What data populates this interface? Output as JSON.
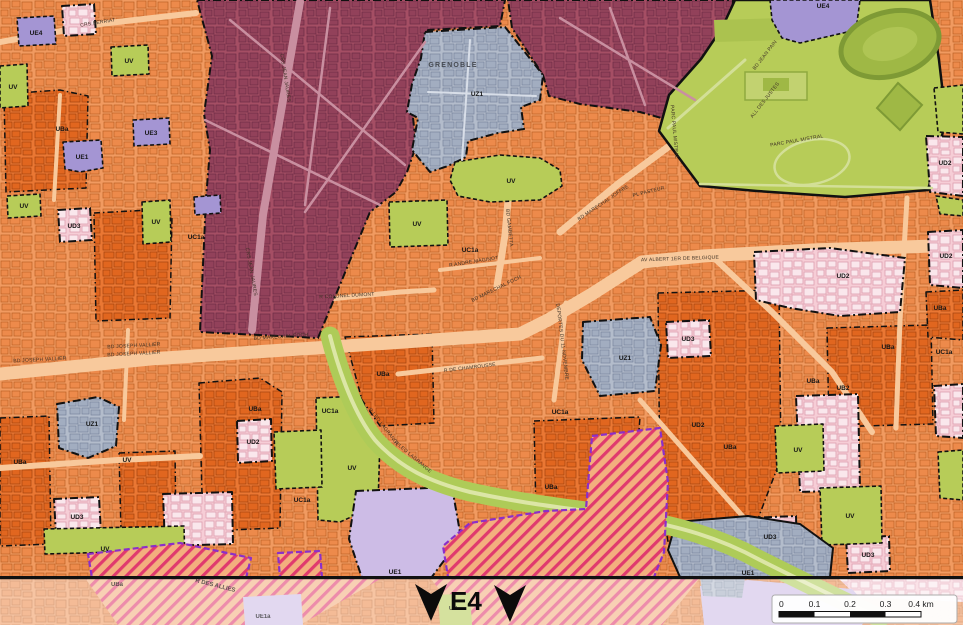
{
  "sheet": {
    "label": "E4"
  },
  "city_label": {
    "text": "GRENOBLE",
    "x": 453,
    "y": 67
  },
  "palette": {
    "base_orange": "#F19A60",
    "deep_orange": "#EA7733",
    "road": "#F8C99C",
    "maroon": "#A54E64",
    "blue_gray": "#B3BCCB",
    "green": "#B7CC58",
    "pink": "#F6CDD6",
    "purple": "#A495D3",
    "light_purple": "#CDBCE6",
    "hatch_stripe": "#E03A6E",
    "hatch_border": "#8B2FC9",
    "divider": "#111111"
  },
  "deep_zones": [
    {
      "n": "UBa",
      "f": "deep",
      "s": "dash1",
      "p": "4,94 60,90 88,96 86,188 6,192"
    },
    {
      "n": "UBa",
      "f": "deep",
      "s": "dash1",
      "p": "94,213 150,210 172,216 170,318 96,321"
    },
    {
      "n": "UBa",
      "f": "deep",
      "s": "dash1",
      "p": "345,337 432,334 434,423 380,426 362,400"
    },
    {
      "n": "UBa",
      "f": "deep",
      "s": "dash1",
      "p": "119,453 175,451 176,529 121,531"
    },
    {
      "n": "UBa",
      "f": "deep",
      "s": "dash1",
      "p": "0,418 49,416 51,544 0,546"
    },
    {
      "n": "UBa",
      "f": "deep",
      "s": "dash1",
      "p": "199,383 260,378 282,392 280,528 203,531"
    },
    {
      "n": "UBa",
      "f": "deep",
      "s": "dash1",
      "p": "658,293 779,290 781,458 750,540 668,542 660,492"
    },
    {
      "n": "UBa",
      "f": "deep",
      "s": "dash1",
      "p": "827,328 931,325 933,424 829,427"
    },
    {
      "n": "UBa",
      "f": "deep",
      "s": "dash1",
      "p": "534,421 640,417 636,470 600,478 594,508 536,513"
    },
    {
      "n": "UBa",
      "f": "deep",
      "s": "dash1",
      "p": "926,292 963,290 963,340 928,337"
    }
  ],
  "roads": [
    {
      "d": "M0,374 L150,359 L360,345 L520,334 L548,320 L592,294 L642,262 L703,256 L812,250 L963,245",
      "w": 13
    },
    {
      "d": "M497,286 L505,235 L510,178",
      "w": 7
    },
    {
      "d": "M560,232 L618,184 L668,147 L702,127",
      "w": 7
    },
    {
      "d": "M713,257 L772,312 L832,372 L872,432",
      "w": 6
    },
    {
      "d": "M398,374 L470,366 L542,358",
      "w": 5
    },
    {
      "d": "M554,400 L562,338 L566,303",
      "w": 5
    },
    {
      "d": "M320,300 L400,292 L434,290",
      "w": 5
    },
    {
      "d": "M0,42 L100,24 L196,13",
      "w": 6
    },
    {
      "d": "M640,400 L700,468 L746,520",
      "w": 5
    },
    {
      "d": "M907,198 L900,320 L896,428",
      "w": 5
    },
    {
      "d": "M440,270 L540,258",
      "w": 4
    },
    {
      "d": "M60,95 L54,200",
      "w": 4
    },
    {
      "d": "M128,330 L124,420",
      "w": 4
    },
    {
      "d": "M0,468 L118,460 L200,456",
      "w": 6
    }
  ],
  "zones": [
    {
      "n": "UA-center",
      "f": "ma",
      "s": "dash",
      "p": "197,0 505,0 500,26 428,30 422,58 412,108 416,146 407,172 396,192 370,212 318,338 200,332 206,198 210,150 204,114 212,56"
    },
    {
      "n": "UA-center-east",
      "f": "ma",
      "s": "dash",
      "p": "508,0 733,0 730,64 708,94 697,128 640,112 580,104 549,96 543,75 512,28"
    },
    {
      "n": "parc-paul-mistral",
      "f": "park",
      "s": "solid2",
      "p": "735,0 930,0 939,60 946,120 937,155 928,190 845,197 757,191 700,186 659,131 669,95 701,59 722,28"
    },
    {
      "n": "park-block",
      "f": "dkgreen",
      "s": "none",
      "p": "714,20 783,18 782,40 715,42"
    },
    {
      "n": "UE4",
      "f": "pu",
      "s": "dashf",
      "p": "770,0 860,0 856,30 800,43 782,38 772,20"
    },
    {
      "n": "UV",
      "f": "uv",
      "s": "dashf",
      "p": "934,88 963,85 963,134 938,132"
    },
    {
      "n": "UD2",
      "f": "pk",
      "s": "dash",
      "p": "926,136 963,137 963,196 930,192"
    },
    {
      "n": "UV",
      "f": "uv",
      "s": "dashf",
      "p": "936,196 963,200 963,216 940,214"
    },
    {
      "n": "UD2",
      "f": "pk",
      "s": "dash",
      "p": "928,232 963,230 963,288 930,285"
    },
    {
      "n": "UV",
      "f": "uv",
      "s": "dashf",
      "p": "938,452 963,450 963,500 940,498"
    },
    {
      "n": "UD",
      "f": "pk",
      "s": "dash",
      "p": "62,6 94,4 96,34 64,36"
    },
    {
      "n": "UE4",
      "f": "pu",
      "s": "dashf",
      "p": "17,18 54,16 56,44 19,46"
    },
    {
      "n": "UV",
      "f": "uv",
      "s": "dashf",
      "p": "111,47 148,45 149,74 112,76"
    },
    {
      "n": "UV",
      "f": "uv",
      "s": "dashf",
      "p": "0,66 27,64 28,106 0,108"
    },
    {
      "n": "UE3",
      "f": "pu",
      "s": "dashf",
      "p": "133,120 169,118 170,144 134,146"
    },
    {
      "n": "UE1",
      "f": "pu",
      "s": "dashf",
      "p": "63,142 101,140 103,168 80,172 65,169"
    },
    {
      "n": "UD3",
      "f": "pk",
      "s": "dash",
      "p": "58,210 90,208 92,240 60,242"
    },
    {
      "n": "UV",
      "f": "uv",
      "s": "dashf",
      "p": "7,196 40,194 41,216 8,218"
    },
    {
      "n": "UV",
      "f": "uv",
      "s": "dashf",
      "p": "142,202 170,200 171,242 143,244"
    },
    {
      "n": "UE1",
      "f": "pu",
      "s": "dashf",
      "p": "194,197 220,195 221,213 195,215"
    },
    {
      "n": "UZ1-grenoble",
      "f": "gy",
      "s": "dash",
      "p": "425,32 505,27 543,75 540,100 521,107 524,129 498,133 468,141 466,157 448,166 430,172 412,150 418,118 407,112 412,84 421,58"
    },
    {
      "n": "UV",
      "f": "uv",
      "s": "dashf",
      "p": "455,162 500,155 540,158 560,170 562,186 540,200 490,202 458,196 450,180"
    },
    {
      "n": "UV",
      "f": "uv",
      "s": "dashf",
      "p": "389,202 447,200 448,245 390,247"
    },
    {
      "n": "UZ1",
      "f": "gy",
      "s": "dash",
      "p": "583,322 650,317 661,345 655,391 600,396 582,360"
    },
    {
      "n": "UZ1",
      "f": "gy",
      "s": "dash",
      "p": "57,404 98,397 119,407 116,446 88,458 59,448"
    },
    {
      "n": "UD2",
      "f": "pk",
      "s": "dash",
      "p": "754,252 830,248 905,258 900,312 840,316 790,308 756,300"
    },
    {
      "n": "UD3",
      "f": "pk",
      "s": "dash",
      "p": "666,322 709,320 711,356 668,358"
    },
    {
      "n": "UD2",
      "f": "pk",
      "s": "dash",
      "p": "796,396 858,394 860,490 800,492"
    },
    {
      "n": "UD2",
      "f": "pk",
      "s": "dash",
      "p": "237,421 271,419 272,461 238,463"
    },
    {
      "n": "UD3",
      "f": "pk",
      "s": "dash",
      "p": "54,499 99,497 101,534 56,536"
    },
    {
      "n": "UD",
      "f": "pk",
      "s": "dash",
      "p": "163,494 232,492 233,544 165,546"
    },
    {
      "n": "UD3",
      "f": "pk",
      "s": "dash",
      "p": "748,518 796,516 797,556 750,558"
    },
    {
      "n": "UD3",
      "f": "pk",
      "s": "dash",
      "p": "846,538 889,536 890,571 848,573"
    },
    {
      "n": "UD",
      "f": "pk",
      "s": "dash",
      "p": "934,386 963,384 963,438 936,436"
    },
    {
      "n": "UV",
      "f": "uv",
      "s": "dashf",
      "p": "44,529 184,526 185,566 120,568 118,552 45,554"
    },
    {
      "n": "UV",
      "f": "uv",
      "s": "dashf",
      "p": "316,398 360,396 380,440 378,505 340,522 318,520"
    },
    {
      "n": "UV",
      "f": "uv",
      "s": "dashf",
      "p": "274,432 321,430 322,487 276,489"
    },
    {
      "n": "UV",
      "f": "uv",
      "s": "dashf",
      "p": "775,426 823,424 824,471 777,473"
    },
    {
      "n": "UV",
      "f": "uv",
      "s": "dashf",
      "p": "820,488 881,486 882,543 822,545"
    },
    {
      "n": "UE1",
      "f": "pulight",
      "s": "dash",
      "p": "356,491 452,487 461,538 431,578 362,578 349,539"
    },
    {
      "n": "UE1",
      "f": "gy",
      "s": "solid",
      "p": "676,522 748,516 800,524 833,548 830,577 680,577 668,550"
    }
  ],
  "zone_roads": [
    {
      "d": "M300,2 L283,100 L263,215 L252,330",
      "w": 8,
      "c": "#C98FA0"
    },
    {
      "d": "M230,20 L405,165",
      "w": 2.5,
      "c": "#C98FA0"
    },
    {
      "d": "M205,120 L380,205",
      "w": 2.5,
      "c": "#C98FA0"
    },
    {
      "d": "M330,8 L305,205",
      "w": 2.5,
      "c": "#C98FA0"
    },
    {
      "d": "M425,42 L305,212",
      "w": 2.5,
      "c": "#C98FA0"
    },
    {
      "d": "M560,18 L695,100",
      "w": 2.5,
      "c": "#C98FA0"
    },
    {
      "d": "M610,8 L645,105",
      "w": 2.5,
      "c": "#C98FA0"
    },
    {
      "d": "M470,40 L462,160",
      "w": 2,
      "c": "#D8DEE8"
    },
    {
      "d": "M428,92 L536,96",
      "w": 2,
      "c": "#D8DEE8"
    },
    {
      "d": "M700,184 L932,188",
      "w": 2.5,
      "c": "#D3DF97"
    },
    {
      "d": "M668,128 L745,60",
      "w": 3,
      "c": "#D3DF97"
    }
  ],
  "park_decor": [
    {
      "t": "ellipse",
      "cx": 890,
      "cy": 44,
      "rx": 50,
      "ry": 32,
      "rot": -15,
      "f": "#9FB845",
      "sc": "#7E9A35",
      "w": 5
    },
    {
      "t": "ellipse",
      "cx": 890,
      "cy": 44,
      "rx": 28,
      "ry": 16,
      "rot": -15,
      "f": "#AFC554",
      "sc": "none",
      "w": 0
    },
    {
      "t": "poly",
      "p": "877,108 898,83 922,105 900,130",
      "f": "#9FB845",
      "sc": "#7E9A35",
      "w": 2
    },
    {
      "t": "ellipse",
      "cx": 812,
      "cy": 162,
      "rx": 38,
      "ry": 22,
      "rot": -12,
      "f": "none",
      "sc": "#D3DF97",
      "w": 2.5
    },
    {
      "t": "rect",
      "x": 745,
      "y": 72,
      "wd": 62,
      "ht": 28,
      "f": "#C2D270",
      "sc": "#8FA93F",
      "w": 1.5
    },
    {
      "t": "rect",
      "x": 763,
      "y": 78,
      "wd": 26,
      "ht": 13,
      "f": "#9FB845",
      "sc": "none",
      "w": 0
    }
  ],
  "green_band": {
    "d": "M330,336 C340,375 355,415 375,440 C400,468 430,482 470,492 C530,505 570,508 620,516 C680,526 720,538 760,560 C800,580 840,600 880,618",
    "w": 19,
    "c": "#AECB58",
    "inner_w": 4,
    "inner_c": "#DCE6A6"
  },
  "hatch_zones": [
    {
      "n": "UBa-hatch",
      "f": "ht",
      "s": "purple",
      "p": "592,436 660,428 668,482 664,552 654,577 448,577 443,546 470,523 546,511 586,509"
    },
    {
      "n": "UBa-hatch",
      "f": "ht",
      "s": "purple",
      "p": "88,554 180,543 251,558 246,578 92,578"
    },
    {
      "n": "UBa-hatch",
      "f": "ht",
      "s": "purple",
      "p": "278,553 320,551 322,578 280,578"
    }
  ],
  "zone_labels": [
    [
      "UE4",
      36,
      35
    ],
    [
      "UV",
      129,
      63
    ],
    [
      "UV",
      13,
      89
    ],
    [
      "UBa",
      62,
      131
    ],
    [
      "UE3",
      151,
      135
    ],
    [
      "UE1",
      82,
      159
    ],
    [
      "UD3",
      74,
      228
    ],
    [
      "UV",
      24,
      208
    ],
    [
      "UV",
      156,
      224
    ],
    [
      "UC1a",
      196,
      239
    ],
    [
      "UZ1",
      477,
      96
    ],
    [
      "UV",
      511,
      183
    ],
    [
      "UE4",
      823,
      8
    ],
    [
      "UV",
      417,
      226
    ],
    [
      "UC1a",
      470,
      252
    ],
    [
      "UD2",
      945,
      165
    ],
    [
      "UD2",
      946,
      258
    ],
    [
      "UBa",
      940,
      310
    ],
    [
      "UC1a",
      944,
      354
    ],
    [
      "UD2",
      843,
      278
    ],
    [
      "UD3",
      688,
      341
    ],
    [
      "UBa",
      888,
      349
    ],
    [
      "UZ1",
      625,
      360
    ],
    [
      "UBa",
      383,
      376
    ],
    [
      "UBa",
      255,
      411
    ],
    [
      "UZ1",
      92,
      426
    ],
    [
      "UBa",
      20,
      464
    ],
    [
      "UV",
      127,
      462
    ],
    [
      "UD2",
      253,
      444
    ],
    [
      "UD3",
      77,
      519
    ],
    [
      "UV",
      105,
      551
    ],
    [
      "UC1a",
      302,
      502
    ],
    [
      "UV",
      352,
      470
    ],
    [
      "UC1a",
      330,
      413
    ],
    [
      "UC1a",
      560,
      414
    ],
    [
      "UBa",
      551,
      489
    ],
    [
      "UE1",
      395,
      574
    ],
    [
      "UD2",
      698,
      427
    ],
    [
      "UBa",
      730,
      449
    ],
    [
      "UV",
      798,
      452
    ],
    [
      "UV",
      850,
      518
    ],
    [
      "UD3",
      770,
      539
    ],
    [
      "UD3",
      868,
      557
    ],
    [
      "UB2",
      843,
      390
    ],
    [
      "UBa",
      813,
      383
    ],
    [
      "UE1",
      748,
      575
    ]
  ],
  "street_labels": [
    [
      "CRS BERRIAT",
      98,
      24,
      -9
    ],
    [
      "CRS JEAN JAURES",
      284,
      78,
      81
    ],
    [
      "CRS JEAN JAURES",
      250,
      272,
      80
    ],
    [
      "BD GAMBETTA",
      508,
      228,
      84
    ],
    [
      "BD MARECHAL JOFFRE",
      604,
      204,
      -34
    ],
    [
      "PL PASTEUR",
      649,
      193,
      -14
    ],
    [
      "AV ALBERT 1ER DE BELGIQUE",
      680,
      260,
      -2
    ],
    [
      "BD MARECHAL FOCH",
      497,
      290,
      -26
    ],
    [
      "BD MARECHAL FOCH",
      281,
      338,
      -4
    ],
    [
      "BD JOSEPH VALLIER",
      40,
      361,
      -3
    ],
    [
      "BD JOSEPH VALLIER",
      134,
      347,
      -3
    ],
    [
      "BD JOSEPH VALLIER",
      134,
      355,
      -3
    ],
    [
      "BD JEAN PAIN",
      766,
      56,
      -52
    ],
    [
      "ALL DES JUSTES",
      766,
      101,
      -52
    ],
    [
      "PARC PAUL MISTRAL",
      797,
      142,
      -10
    ],
    [
      "PARC PAUL MISTRAL",
      673,
      132,
      85
    ],
    [
      "R LEO LAGRANGE",
      383,
      428,
      52
    ],
    [
      "R LEO LAGRANGE",
      412,
      458,
      40
    ],
    [
      "DEPORTES DU 11 NOVEMBRE",
      561,
      342,
      83
    ],
    [
      "R DE CHAMROUSSE",
      470,
      369,
      -7
    ],
    [
      "R COLONEL DUMONT",
      347,
      297,
      -3
    ],
    [
      "R ANDRE MAGINOT",
      474,
      263,
      -9
    ]
  ],
  "strip": {
    "white_opacity": 0.42,
    "shapes": [
      {
        "t": "poly",
        "p": "838,578 963,578 963,602 858,597",
        "f": "pk"
      },
      {
        "t": "poly",
        "p": "85,578 382,578 300,625 118,625",
        "f": "ht"
      },
      {
        "t": "poly",
        "p": "430,578 700,578 662,625 468,625",
        "f": "ht"
      },
      {
        "t": "poly",
        "p": "243,597 301,594 303,625 245,625",
        "f": "pulight"
      },
      {
        "t": "poly",
        "p": "700,586 748,580 852,589 872,611 862,625 704,625",
        "f": "pulight"
      },
      {
        "t": "poly",
        "p": "700,578 745,578 742,598 703,596",
        "f": "gy"
      },
      {
        "t": "poly",
        "p": "438,595 470,593 472,625 440,625",
        "f": "uv"
      }
    ],
    "labels": [
      [
        "UBa",
        117,
        586,
        0
      ],
      [
        "R DES ALLIES",
        215,
        587,
        14
      ],
      [
        "UE1a",
        263,
        618,
        0
      ],
      [
        "UV",
        453,
        610,
        0
      ]
    ]
  },
  "markers": {
    "sheet_label": "E4",
    "x": 450,
    "y": 610,
    "arrows": [
      [
        431,
        584
      ],
      [
        510,
        585
      ]
    ]
  },
  "scalebar": {
    "x": 772,
    "y": 595,
    "w": 185,
    "h": 28,
    "ticks": [
      "0",
      "0.1",
      "0.2",
      "0.3",
      "0.4 km"
    ],
    "bar": {
      "x": 779,
      "y": 611.5,
      "w": 142,
      "h": 5.5
    }
  }
}
